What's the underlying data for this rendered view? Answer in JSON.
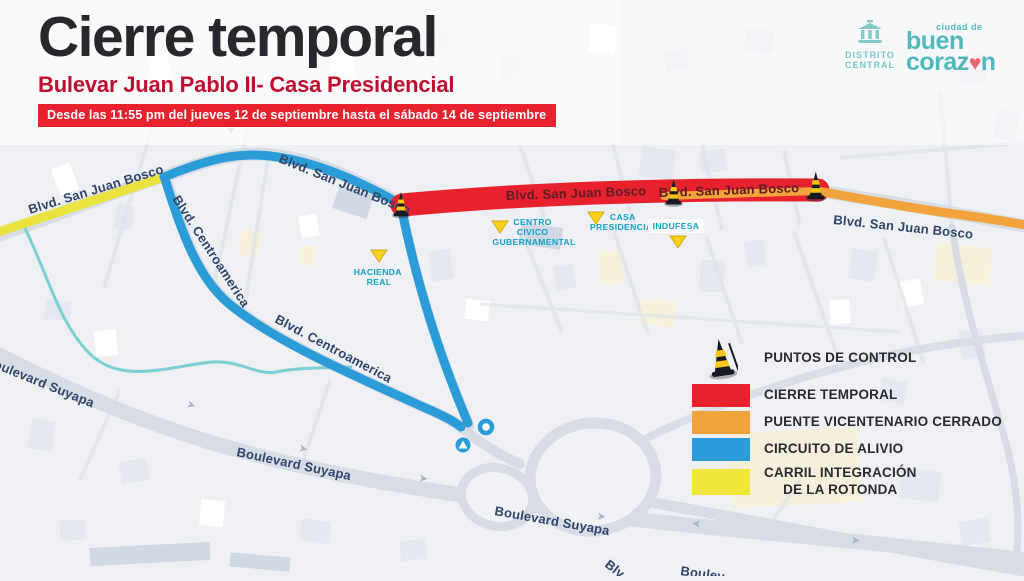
{
  "header": {
    "title": "Cierre temporal",
    "subtitle": "Bulevar Juan Pablo II- Casa Presidencial",
    "banner": "Desde las 11:55 pm del jueves 12 de septiembre hasta el sábado 14 de septiembre"
  },
  "logos": {
    "district": {
      "line1": "DISTRITO",
      "line2": "CENTRAL"
    },
    "city": {
      "tagline": "ciudad de",
      "word1": "buen",
      "word2_start": "coraz",
      "word2_end": "n"
    }
  },
  "map": {
    "road_labels": [
      "Blvd. San Juan Bosco",
      "Blvd. Centroamerica",
      "Boulevard Suyapa",
      "Blv",
      "Boulev"
    ],
    "pois": [
      {
        "lines": [
          "CENTRO",
          "CIVICO",
          "GUBERNAMENTAL"
        ]
      },
      {
        "lines": [
          "CASA",
          "PRESIDENCIAL"
        ]
      },
      {
        "lines": [
          "INDUFESA"
        ]
      },
      {
        "lines": [
          "HACIENDA",
          "REAL"
        ]
      }
    ]
  },
  "legend": {
    "control_label": "PUNTOS DE CONTROL",
    "items": [
      {
        "label": "CIERRE TEMPORAL",
        "color": "#e8212e"
      },
      {
        "label": "PUENTE VICENTENARIO CERRADO",
        "color": "#f2a33b"
      },
      {
        "label": "CIRCUITO DE ALIVIO",
        "color": "#2b9cd8"
      },
      {
        "label": "CARRIL INTEGRACIÓN",
        "label_line2": "DE LA ROTONDA",
        "color": "#efe73a"
      }
    ]
  },
  "colors": {
    "red": "#e8212e",
    "orange": "#f2a33b",
    "blue": "#2b9cd8",
    "yellow": "#e9e33f",
    "crimson": "#bf0f31",
    "teal": "#3fb0b5",
    "poi_teal": "#12a0c6",
    "road_label_navy": "#31456a",
    "title_dark": "#28272d",
    "heart_red": "#e8555f"
  }
}
